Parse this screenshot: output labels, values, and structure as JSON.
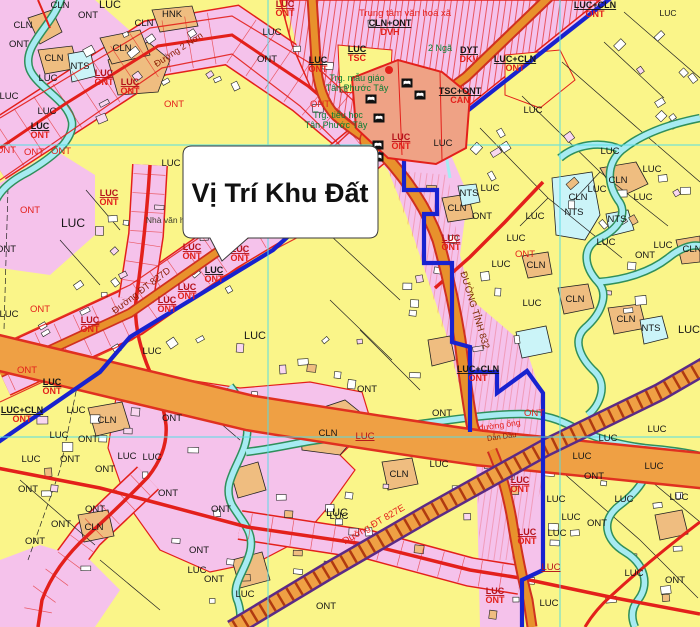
{
  "window": {
    "width": 700,
    "height": 627
  },
  "callout": {
    "text": "Vị Trí Khu Đất"
  },
  "colors": {
    "base_yellow": "#FAF589",
    "residential_pink": "#F5C2EB",
    "orchard_orange": "#EFBD80",
    "water_cyan": "#A7EBF2",
    "pond_cyan": "#CBF4F8",
    "road_orange": "#E8912C",
    "freeway_orange": "#EFA044",
    "road_red": "#E3201B",
    "boundary_blue": "#1822CF",
    "grid_cyan": "#55DDE4",
    "school_salmon": "#EFA285",
    "band_purple": "#5B2A86"
  },
  "legend": {
    "land_codes": [
      "LUC",
      "ONT",
      "CLN",
      "NTS",
      "HNK",
      "TSC",
      "DVH",
      "DYT",
      "DKV",
      "CAN",
      "LUC+CLN",
      "CLN+ONT",
      "TSC+ONT"
    ]
  },
  "labels": {
    "codes": [
      {
        "t": "LUC",
        "x": 110,
        "y": 8,
        "s": "k",
        "fs": 11
      },
      {
        "t": "CLN",
        "x": 60,
        "y": 8,
        "s": "k"
      },
      {
        "t": "ONT",
        "x": 88,
        "y": 18,
        "s": "k"
      },
      {
        "t": "CLN",
        "x": 23,
        "y": 28,
        "s": "k"
      },
      {
        "t": "ONT",
        "x": 19,
        "y": 47,
        "s": "k"
      },
      {
        "t": "CLN",
        "x": 144,
        "y": 26,
        "s": "k"
      },
      {
        "t": "HNK",
        "x": 172,
        "y": 17,
        "s": "k"
      },
      {
        "t": "CLN",
        "x": 122,
        "y": 51,
        "s": "k"
      },
      {
        "t": "CLN",
        "x": 54,
        "y": 61,
        "s": "k"
      },
      {
        "t": "NTS",
        "x": 80,
        "y": 69,
        "s": "k"
      },
      {
        "t": "LUC",
        "x": 48,
        "y": 81,
        "s": "k"
      },
      {
        "t": "LUC",
        "x": 9,
        "y": 99,
        "s": "k"
      },
      {
        "t": "LUC",
        "x": 47,
        "y": 114,
        "s": "k"
      },
      {
        "t": "ONT",
        "x": 174,
        "y": 107,
        "s": "r"
      },
      {
        "t": "ONT",
        "x": 34,
        "y": 155,
        "s": "r"
      },
      {
        "t": "ONT",
        "x": 61,
        "y": 154,
        "s": "r"
      },
      {
        "t": "ONT",
        "x": 6,
        "y": 153,
        "s": "r"
      },
      {
        "t": "LUC",
        "x": 171,
        "y": 166,
        "s": "k"
      },
      {
        "t": "LUC",
        "x": 272,
        "y": 35,
        "s": "k"
      },
      {
        "t": "ONT",
        "x": 267,
        "y": 62,
        "s": "k"
      },
      {
        "t": "ONT",
        "x": 320,
        "y": 107,
        "s": "r"
      },
      {
        "t": "LUC",
        "x": 533,
        "y": 113,
        "s": "k"
      },
      {
        "t": "LUC",
        "x": 668,
        "y": 16,
        "s": "k",
        "fs": 8.5
      },
      {
        "t": "LUC",
        "x": 443,
        "y": 146,
        "s": "k"
      },
      {
        "t": "LUC",
        "x": 610,
        "y": 154,
        "s": "k"
      },
      {
        "t": "CLN",
        "x": 618,
        "y": 183,
        "s": "k"
      },
      {
        "t": "LUC",
        "x": 597,
        "y": 192,
        "s": "k"
      },
      {
        "t": "LUC",
        "x": 652,
        "y": 172,
        "s": "k"
      },
      {
        "t": "CLN",
        "x": 578,
        "y": 200,
        "s": "k"
      },
      {
        "t": "NTS",
        "x": 574,
        "y": 215,
        "s": "k"
      },
      {
        "t": "LUC",
        "x": 643,
        "y": 200,
        "s": "k"
      },
      {
        "t": "NTS",
        "x": 617,
        "y": 222,
        "s": "k"
      },
      {
        "t": "LUC",
        "x": 606,
        "y": 245,
        "s": "k"
      },
      {
        "t": "LUC",
        "x": 663,
        "y": 248,
        "s": "k"
      },
      {
        "t": "ONT",
        "x": 645,
        "y": 258,
        "s": "k"
      },
      {
        "t": "CLN",
        "x": 692,
        "y": 252,
        "s": "k"
      },
      {
        "t": "CLN",
        "x": 575,
        "y": 302,
        "s": "k"
      },
      {
        "t": "CLN",
        "x": 626,
        "y": 322,
        "s": "k"
      },
      {
        "t": "NTS",
        "x": 651,
        "y": 331,
        "s": "k"
      },
      {
        "t": "LUC",
        "x": 689,
        "y": 333,
        "s": "k",
        "fs": 11
      },
      {
        "t": "LUC",
        "x": 490,
        "y": 191,
        "s": "k"
      },
      {
        "t": "NTS",
        "x": 469,
        "y": 196,
        "s": "k"
      },
      {
        "t": "CLN",
        "x": 457,
        "y": 211,
        "s": "k"
      },
      {
        "t": "ONT",
        "x": 482,
        "y": 219,
        "s": "k"
      },
      {
        "t": "LUC",
        "x": 535,
        "y": 219,
        "s": "k"
      },
      {
        "t": "LUC",
        "x": 516,
        "y": 241,
        "s": "k"
      },
      {
        "t": "CLN",
        "x": 536,
        "y": 268,
        "s": "k"
      },
      {
        "t": "LUC",
        "x": 501,
        "y": 267,
        "s": "k"
      },
      {
        "t": "ONT",
        "x": 525,
        "y": 257,
        "s": "r"
      },
      {
        "t": "LUC",
        "x": 532,
        "y": 306,
        "s": "k"
      },
      {
        "t": "LUC",
        "x": 73,
        "y": 227,
        "s": "k",
        "fs": 12
      },
      {
        "t": "ONT",
        "x": 30,
        "y": 213,
        "s": "r"
      },
      {
        "t": "ONT",
        "x": 6,
        "y": 252,
        "s": "k"
      },
      {
        "t": "ONT",
        "x": 40,
        "y": 312,
        "s": "r"
      },
      {
        "t": "LUC",
        "x": 9,
        "y": 317,
        "s": "k"
      },
      {
        "t": "LUC",
        "x": 255,
        "y": 339,
        "s": "k",
        "fs": 11
      },
      {
        "t": "LUC",
        "x": 152,
        "y": 354,
        "s": "k"
      },
      {
        "t": "ONT",
        "x": 367,
        "y": 392,
        "s": "k"
      },
      {
        "t": "ONT",
        "x": 442,
        "y": 416,
        "s": "k"
      },
      {
        "t": "ONT",
        "x": 534,
        "y": 416,
        "s": "r"
      },
      {
        "t": "CLN",
        "x": 328,
        "y": 436,
        "s": "k"
      },
      {
        "t": "LUC",
        "x": 365,
        "y": 439,
        "s": "m"
      },
      {
        "t": "LUC",
        "x": 439,
        "y": 467,
        "s": "k"
      },
      {
        "t": "CLN",
        "x": 399,
        "y": 477,
        "s": "k"
      },
      {
        "t": "LUC",
        "x": 337,
        "y": 516,
        "s": "k",
        "fs": 11
      },
      {
        "t": "ONT",
        "x": 27,
        "y": 373,
        "s": "r"
      },
      {
        "t": "LUC",
        "x": 76,
        "y": 413,
        "s": "k"
      },
      {
        "t": "CLN",
        "x": 107,
        "y": 423,
        "s": "k"
      },
      {
        "t": "ONT",
        "x": 172,
        "y": 421,
        "s": "k"
      },
      {
        "t": "LUC",
        "x": 59,
        "y": 438,
        "s": "k"
      },
      {
        "t": "ONT",
        "x": 88,
        "y": 442,
        "s": "k"
      },
      {
        "t": "LUC",
        "x": 31,
        "y": 462,
        "s": "k"
      },
      {
        "t": "ONT",
        "x": 70,
        "y": 462,
        "s": "k"
      },
      {
        "t": "ONT",
        "x": 105,
        "y": 472,
        "s": "k"
      },
      {
        "t": "LUC",
        "x": 127,
        "y": 459,
        "s": "k"
      },
      {
        "t": "LUC",
        "x": 152,
        "y": 460,
        "s": "k"
      },
      {
        "t": "ONT",
        "x": 28,
        "y": 492,
        "s": "k"
      },
      {
        "t": "ONT",
        "x": 61,
        "y": 527,
        "s": "k"
      },
      {
        "t": "ONT",
        "x": 35,
        "y": 544,
        "s": "k"
      },
      {
        "t": "ONT",
        "x": 95,
        "y": 512,
        "s": "k"
      },
      {
        "t": "CLN",
        "x": 94,
        "y": 530,
        "s": "k"
      },
      {
        "t": "ONT",
        "x": 168,
        "y": 496,
        "s": "k"
      },
      {
        "t": "ONT",
        "x": 221,
        "y": 512,
        "s": "k"
      },
      {
        "t": "LUC",
        "x": 339,
        "y": 519,
        "s": "k"
      },
      {
        "t": "ONT",
        "x": 199,
        "y": 553,
        "s": "k"
      },
      {
        "t": "LUC",
        "x": 197,
        "y": 573,
        "s": "k"
      },
      {
        "t": "ONT",
        "x": 214,
        "y": 582,
        "s": "k"
      },
      {
        "t": "LUC",
        "x": 245,
        "y": 597,
        "s": "k"
      },
      {
        "t": "ONT",
        "x": 326,
        "y": 609,
        "s": "k"
      },
      {
        "t": "LUC",
        "x": 657,
        "y": 432,
        "s": "k"
      },
      {
        "t": "LUC",
        "x": 608,
        "y": 441,
        "s": "k"
      },
      {
        "t": "LUC",
        "x": 582,
        "y": 459,
        "s": "k"
      },
      {
        "t": "LUC",
        "x": 654,
        "y": 469,
        "s": "k"
      },
      {
        "t": "ONT",
        "x": 594,
        "y": 479,
        "s": "k"
      },
      {
        "t": "LUC",
        "x": 679,
        "y": 500,
        "s": "k"
      },
      {
        "t": "LUC",
        "x": 624,
        "y": 502,
        "s": "k"
      },
      {
        "t": "LUC",
        "x": 556,
        "y": 502,
        "s": "k"
      },
      {
        "t": "LUC",
        "x": 571,
        "y": 520,
        "s": "k"
      },
      {
        "t": "ONT",
        "x": 597,
        "y": 526,
        "s": "k"
      },
      {
        "t": "LUC",
        "x": 557,
        "y": 536,
        "s": "k"
      },
      {
        "t": "LUC",
        "x": 551,
        "y": 570,
        "s": "m"
      },
      {
        "t": "LUC",
        "x": 634,
        "y": 576,
        "s": "k"
      },
      {
        "t": "ONT",
        "x": 675,
        "y": 583,
        "s": "k"
      },
      {
        "t": "LUC",
        "x": 549,
        "y": 606,
        "s": "k"
      }
    ],
    "pairs": [
      {
        "a": "LUC",
        "b": "ONT",
        "x": 104,
        "y": 76,
        "s": "mr"
      },
      {
        "a": "LUC",
        "b": "ONT",
        "x": 130,
        "y": 85,
        "s": "mr"
      },
      {
        "a": "LUC",
        "b": "ONT",
        "x": 40,
        "y": 129,
        "s": "kr"
      },
      {
        "a": "LUC",
        "b": "ONT",
        "x": 109,
        "y": 196,
        "s": "mr"
      },
      {
        "a": "LUC",
        "b": "ONT",
        "x": 285,
        "y": 7,
        "s": "mr"
      },
      {
        "a": "LUC",
        "b": "TSC",
        "x": 357,
        "y": 52,
        "s": "kr"
      },
      {
        "a": "CLN+ONT",
        "b": "DVH",
        "x": 390,
        "y": 26,
        "s": "kr"
      },
      {
        "a": "DYT",
        "b": "DKV",
        "x": 469,
        "y": 53,
        "s": "kr"
      },
      {
        "a": "TSC+ONT",
        "b": "CAN",
        "x": 460,
        "y": 94,
        "s": "kr"
      },
      {
        "a": "LUC+CLN",
        "b": "ONT",
        "x": 595,
        "y": 8,
        "s": "kr"
      },
      {
        "a": "LUC+CLN",
        "b": "ONT",
        "x": 515,
        "y": 62,
        "s": "kr"
      },
      {
        "a": "LUC",
        "b": "ONT",
        "x": 318,
        "y": 63,
        "s": "kr"
      },
      {
        "a": "LUC",
        "b": "ONT",
        "x": 401,
        "y": 140,
        "s": "mr"
      },
      {
        "a": "LUC",
        "b": "ONT",
        "x": 451,
        "y": 241,
        "s": "mr"
      },
      {
        "a": "LUC",
        "b": "ONT",
        "x": 192,
        "y": 250,
        "s": "mr"
      },
      {
        "a": "LUC",
        "b": "ONT",
        "x": 240,
        "y": 252,
        "s": "mr"
      },
      {
        "a": "LUC",
        "b": "ONT",
        "x": 214,
        "y": 273,
        "s": "kr"
      },
      {
        "a": "LUC",
        "b": "ONT",
        "x": 187,
        "y": 290,
        "s": "mr"
      },
      {
        "a": "LUC",
        "b": "ONT",
        "x": 167,
        "y": 303,
        "s": "mr"
      },
      {
        "a": "LUC",
        "b": "ONT",
        "x": 90,
        "y": 323,
        "s": "mr"
      },
      {
        "a": "LUC+CLN",
        "b": "ONT",
        "x": 22,
        "y": 413,
        "s": "kr"
      },
      {
        "a": "LUC",
        "b": "ONT",
        "x": 52,
        "y": 385,
        "s": "kr"
      },
      {
        "a": "LUC+CLN",
        "b": "ONT",
        "x": 478,
        "y": 372,
        "s": "kr"
      },
      {
        "a": "LUC",
        "b": "ONT",
        "x": 520,
        "y": 483,
        "s": "mr"
      },
      {
        "a": "LUC",
        "b": "ONT",
        "x": 527,
        "y": 535,
        "s": "mr"
      },
      {
        "a": "LUC",
        "b": "ONT",
        "x": 495,
        "y": 594,
        "s": "mr"
      }
    ],
    "places": [
      {
        "t": "Trung tâm văn hoá xã",
        "x": 405,
        "y": 16,
        "c": "#E3201B",
        "fs": 9.5
      },
      {
        "t": "Trg. mẫu giáo",
        "x": 357,
        "y": 81,
        "c": "#0A7D33",
        "fs": 9
      },
      {
        "t": "Tân Phước Tây",
        "x": 357,
        "y": 91,
        "c": "#0A7D33",
        "fs": 9
      },
      {
        "t": "Trg. tiểu học",
        "x": 338,
        "y": 118,
        "c": "#0A7D33",
        "fs": 9
      },
      {
        "t": "Tân Phước Tây",
        "x": 336,
        "y": 128,
        "c": "#0A7D33",
        "fs": 9
      },
      {
        "t": "2 Ngã",
        "x": 440,
        "y": 51,
        "c": "#0A7D33",
        "fs": 9
      },
      {
        "t": "Nhà văn hoá",
        "x": 170,
        "y": 223,
        "c": "#3a3a2a",
        "fs": 8.5
      }
    ],
    "roads": [
      {
        "t": "Đường 2 Nơn",
        "x": 180,
        "y": 52,
        "rot": -33,
        "c": "#8A1A00",
        "fs": 9
      },
      {
        "t": "Đường ĐT 827D",
        "x": 143,
        "y": 293,
        "rot": -37,
        "c": "#8A1A00",
        "fs": 9.5
      },
      {
        "t": "ĐƯỜNG TỈNH 832",
        "x": 472,
        "y": 311,
        "rot": 73,
        "c": "#7A2A00",
        "fs": 9.5
      },
      {
        "t": "Đường ĐT 827E",
        "x": 375,
        "y": 527,
        "rot": -30,
        "c": "#E3201B",
        "fs": 9.5
      },
      {
        "t": "đường ống",
        "x": 500,
        "y": 428,
        "rot": -8,
        "c": "#E3201B",
        "fs": 8.5
      },
      {
        "t": "Dẫn Dầu",
        "x": 502,
        "y": 439,
        "rot": -8,
        "c": "#8A1A00",
        "fs": 7.5
      }
    ]
  }
}
